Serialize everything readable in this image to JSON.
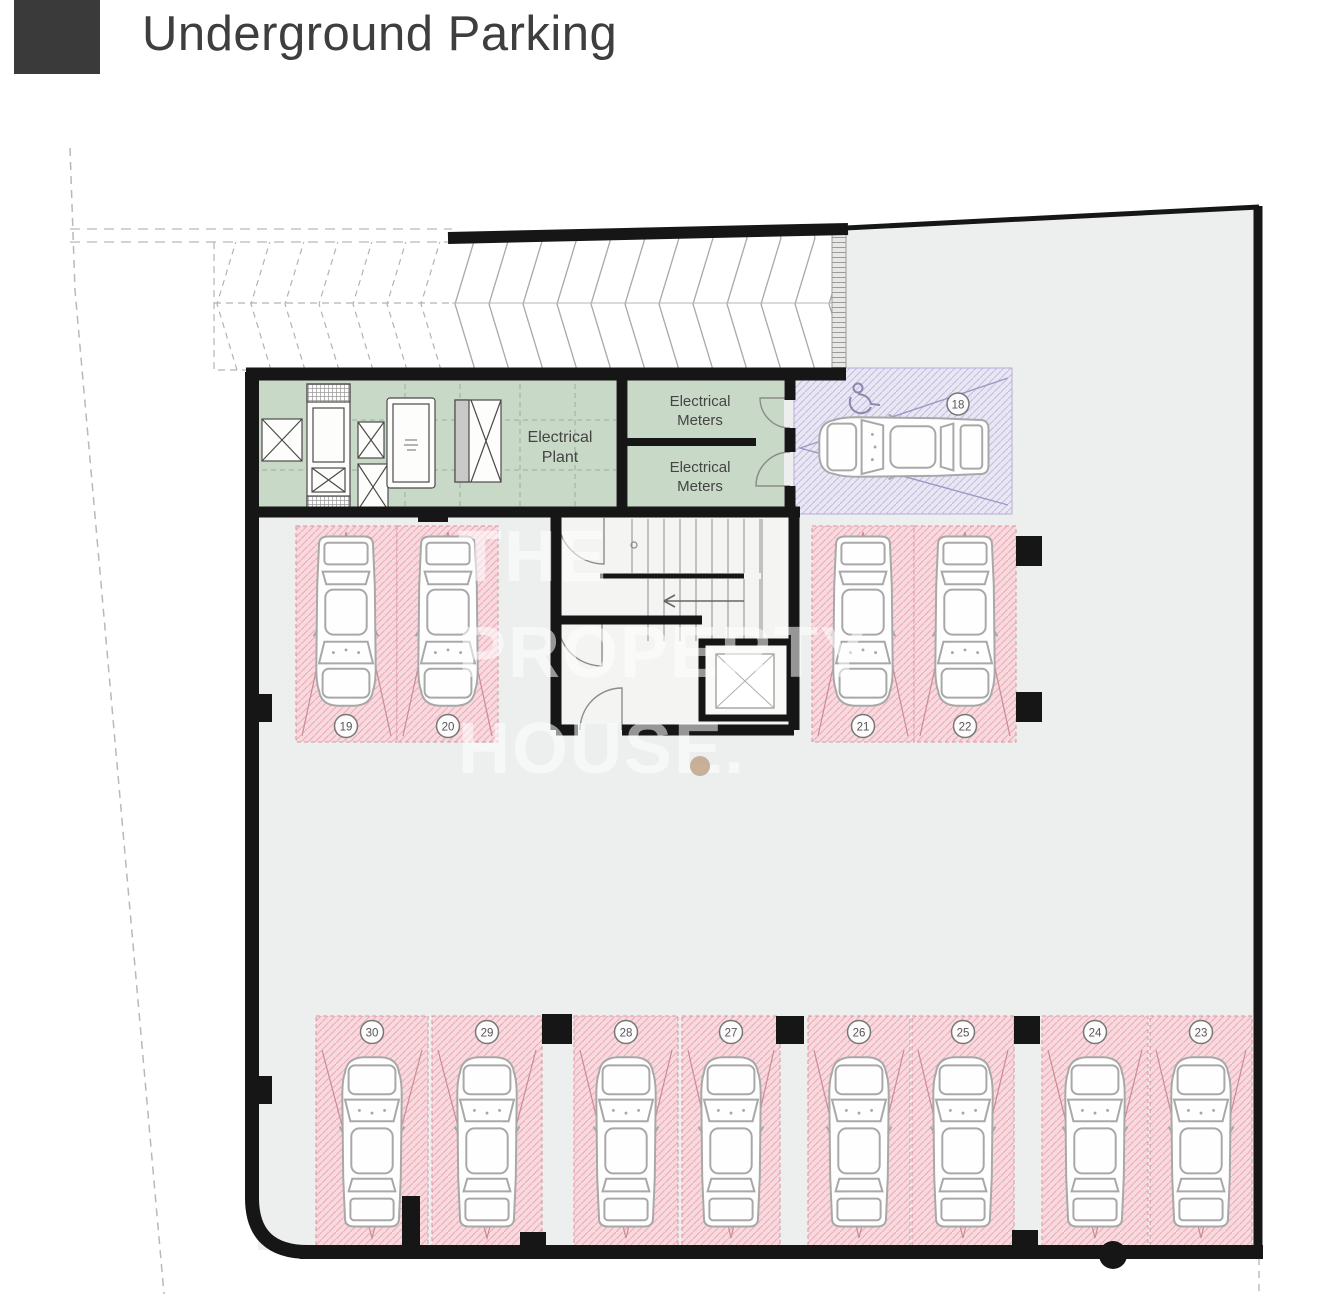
{
  "header": {
    "title": "Underground Parking"
  },
  "plan": {
    "rooms": {
      "plant_line1": "Electrical",
      "plant_line2": "Plant",
      "meters_line1": "Electrical",
      "meters_line2": "Meters"
    },
    "spots": {
      "accessible": "18",
      "upper_left": [
        "19",
        "20"
      ],
      "upper_right": [
        "21",
        "22"
      ],
      "bottom": [
        "30",
        "29",
        "28",
        "27",
        "26",
        "25",
        "24",
        "23"
      ]
    },
    "colors": {
      "wall": "#161616",
      "interior": "#edefee",
      "room_green": "#c9d9c7",
      "spot_pink": "#f8d9de",
      "spot_pink_hatch": "#eaacb8",
      "accessible_purple": "#eae7f5",
      "accessible_hatch": "#c3bbdd",
      "watermark_dot": "#c3a78e",
      "logo": "#3a3a3a"
    }
  },
  "watermark": {
    "line1": "THE",
    "line2": "PROPERTY",
    "line3": "HOUSE."
  }
}
